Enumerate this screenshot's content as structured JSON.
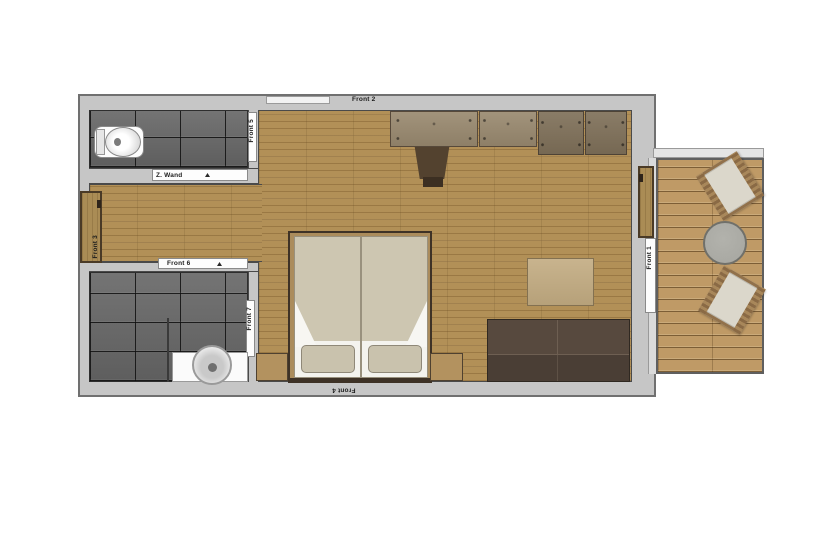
{
  "plan": {
    "wall_labels": {
      "front_1": "Front 1",
      "front_2": "Front 2",
      "front_3": "Front 3",
      "front_4": "Front 4"
    },
    "door_labels": {
      "front_5": "Front 5",
      "front_6": "Front 6",
      "front_7": "Front 7",
      "wc_door": "Z. Wand"
    },
    "colors": {
      "background": "#ffffff",
      "wall": "#c6c6c6",
      "wall_outline": "#707070",
      "wood_floor": "#b29057",
      "tile": "#6a6a6a",
      "deck": "#bf9a66",
      "wardrobe": "#9a8a70",
      "dark_cabinet": "#80715a",
      "dark_furniture": "#57493e",
      "mattress": "#cdc6b1",
      "pillow": "#c9c2ad",
      "rug": "#c2ab81",
      "cushion": "#dbd7cb",
      "table": "#a6a6a0"
    }
  }
}
